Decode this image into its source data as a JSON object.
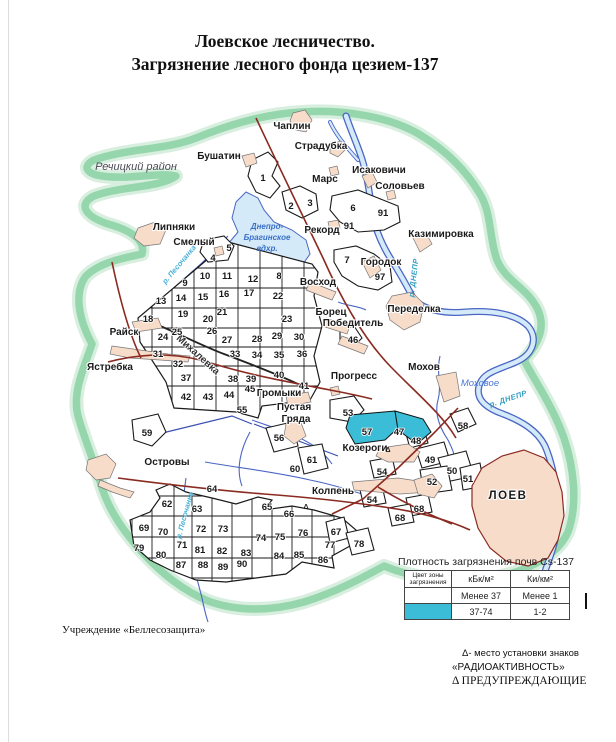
{
  "title": {
    "line1": "Лоевское лесничество.",
    "line2": "Загрязнение лесного фонда цезием-137"
  },
  "colors": {
    "band_green": "#8fd3a6",
    "water_fill": "#d5eaf9",
    "water_line": "#4a66c4",
    "settlement_pink": "#f8dcca",
    "contaminated_cyan": "#3bbdd8",
    "road_dark_red": "#8b2a21"
  },
  "map": {
    "labels": [
      {
        "id": "label-rechitsky-rayon",
        "t": "Речицкий район",
        "x": 136,
        "y": 170,
        "cls": "region"
      },
      {
        "id": "label-chaplin",
        "t": "Чаплин",
        "x": 292,
        "y": 129,
        "cls": "place"
      },
      {
        "id": "label-stradubka",
        "t": "Страдубка",
        "x": 321,
        "y": 149,
        "cls": "place"
      },
      {
        "id": "label-bushatin",
        "t": "Бушатин",
        "x": 219,
        "y": 159,
        "cls": "place"
      },
      {
        "id": "label-mars",
        "t": "Марс",
        "x": 325,
        "y": 182,
        "cls": "place"
      },
      {
        "id": "label-isakovichi",
        "t": "Исаковичи",
        "x": 379,
        "y": 173,
        "cls": "place"
      },
      {
        "id": "label-solovyev",
        "t": "Соловьев",
        "x": 400,
        "y": 189,
        "cls": "place"
      },
      {
        "id": "label-kazimirovka",
        "t": "Казимировка",
        "x": 441,
        "y": 237,
        "cls": "place"
      },
      {
        "id": "label-lipnyaki",
        "t": "Липняки",
        "x": 174,
        "y": 230,
        "cls": "place"
      },
      {
        "id": "label-smely",
        "t": "Смелый",
        "x": 194,
        "y": 245,
        "cls": "place"
      },
      {
        "id": "label-rekord",
        "t": "Рекорд",
        "x": 322,
        "y": 233,
        "cls": "place"
      },
      {
        "id": "label-gorodok",
        "t": "Городок",
        "x": 381,
        "y": 265,
        "cls": "place"
      },
      {
        "id": "label-voskhod",
        "t": "Восход",
        "x": 318,
        "y": 285,
        "cls": "place"
      },
      {
        "id": "label-peredelka",
        "t": "Переделка",
        "x": 414,
        "y": 312,
        "cls": "place"
      },
      {
        "id": "label-borets",
        "t": "Борец",
        "x": 331,
        "y": 315,
        "cls": "place"
      },
      {
        "id": "label-pobeditel",
        "t": "Победитель",
        "x": 353,
        "y": 326,
        "cls": "place"
      },
      {
        "id": "label-raysk",
        "t": "Райск",
        "x": 124,
        "y": 335,
        "cls": "place"
      },
      {
        "id": "label-yastrebka",
        "t": "Ястребка",
        "x": 110,
        "y": 370,
        "cls": "place"
      },
      {
        "id": "label-mikhalevka",
        "t": "Михалевка",
        "x": 196,
        "y": 357,
        "cls": "place-rot",
        "rot": 42
      },
      {
        "id": "label-mokhov",
        "t": "Мохов",
        "x": 424,
        "y": 370,
        "cls": "place"
      },
      {
        "id": "label-progress",
        "t": "Прогресс",
        "x": 354,
        "y": 379,
        "cls": "place"
      },
      {
        "id": "label-gromyki",
        "t": "Громыки",
        "x": 279,
        "y": 396,
        "cls": "place"
      },
      {
        "id": "label-pustaya",
        "t": "Пустая",
        "x": 294,
        "y": 410,
        "cls": "place"
      },
      {
        "id": "label-gryada",
        "t": "Гряда",
        "x": 296,
        "y": 422,
        "cls": "place"
      },
      {
        "id": "label-ostrovy",
        "t": "Островы",
        "x": 167,
        "y": 465,
        "cls": "place"
      },
      {
        "id": "label-kozerogi",
        "t": "Козероги",
        "x": 365,
        "y": 451,
        "cls": "place"
      },
      {
        "id": "label-kolpen",
        "t": "Колпень",
        "x": 333,
        "y": 494,
        "cls": "place"
      },
      {
        "id": "label-loev",
        "t": "ЛОЕВ",
        "x": 508,
        "y": 499,
        "cls": "place-lg"
      },
      {
        "id": "label-reservoir-1",
        "t": "Днепро-",
        "x": 267,
        "y": 229,
        "cls": "water-res"
      },
      {
        "id": "label-reservoir-2",
        "t": "Брагинское",
        "x": 267,
        "y": 240,
        "cls": "water-res"
      },
      {
        "id": "label-reservoir-3",
        "t": "вдхр.",
        "x": 267,
        "y": 251,
        "cls": "water-res"
      },
      {
        "id": "label-pesochanka-upper",
        "t": "р. Песочанка",
        "x": 181,
        "y": 266,
        "cls": "water-sm",
        "rot": -50
      },
      {
        "id": "label-pesochanka-lower",
        "t": "р. Песочанка",
        "x": 187,
        "y": 516,
        "cls": "water-sm",
        "rot": -75
      },
      {
        "id": "label-dnepr-upper",
        "t": "р. ДНЕПР",
        "x": 416,
        "y": 278,
        "cls": "water-riv",
        "rot": -83
      },
      {
        "id": "label-dnepr-lower",
        "t": "р. ДНЕПР",
        "x": 509,
        "y": 401,
        "cls": "water-riv",
        "rot": -18
      },
      {
        "id": "label-mokhovoe",
        "t": "Моховое",
        "x": 480,
        "y": 386,
        "cls": "water-it"
      }
    ],
    "quarters": [
      {
        "id": "q1",
        "n": "1",
        "x": 263,
        "y": 181
      },
      {
        "id": "q2",
        "n": "2",
        "x": 291,
        "y": 209
      },
      {
        "id": "q3",
        "n": "3",
        "x": 310,
        "y": 206
      },
      {
        "id": "q4",
        "n": "4",
        "x": 213,
        "y": 261
      },
      {
        "id": "q5",
        "n": "5",
        "x": 229,
        "y": 251
      },
      {
        "id": "q6",
        "n": "6",
        "x": 353,
        "y": 211
      },
      {
        "id": "q91a",
        "n": "91",
        "x": 383,
        "y": 216
      },
      {
        "id": "q91b",
        "n": "91",
        "x": 349,
        "y": 229
      },
      {
        "id": "q7",
        "n": "7",
        "x": 347,
        "y": 263
      },
      {
        "id": "q97",
        "n": "97",
        "x": 380,
        "y": 280
      },
      {
        "id": "q8",
        "n": "8",
        "x": 279,
        "y": 279
      },
      {
        "id": "q9",
        "n": "9",
        "x": 185,
        "y": 286
      },
      {
        "id": "q10",
        "n": "10",
        "x": 205,
        "y": 279
      },
      {
        "id": "q11",
        "n": "11",
        "x": 227,
        "y": 279
      },
      {
        "id": "q12",
        "n": "12",
        "x": 253,
        "y": 282
      },
      {
        "id": "q13",
        "n": "13",
        "x": 161,
        "y": 304
      },
      {
        "id": "q14",
        "n": "14",
        "x": 181,
        "y": 301
      },
      {
        "id": "q15",
        "n": "15",
        "x": 203,
        "y": 300
      },
      {
        "id": "q16",
        "n": "16",
        "x": 224,
        "y": 297
      },
      {
        "id": "q17",
        "n": "17",
        "x": 249,
        "y": 296
      },
      {
        "id": "q22",
        "n": "22",
        "x": 278,
        "y": 299
      },
      {
        "id": "q18",
        "n": "18",
        "x": 148,
        "y": 322
      },
      {
        "id": "q19",
        "n": "19",
        "x": 183,
        "y": 317
      },
      {
        "id": "q20",
        "n": "20",
        "x": 208,
        "y": 322
      },
      {
        "id": "q21",
        "n": "21",
        "x": 222,
        "y": 315
      },
      {
        "id": "q23",
        "n": "23",
        "x": 287,
        "y": 322
      },
      {
        "id": "q24",
        "n": "24",
        "x": 163,
        "y": 340
      },
      {
        "id": "q25",
        "n": "25",
        "x": 177,
        "y": 335
      },
      {
        "id": "q26",
        "n": "26",
        "x": 212,
        "y": 334
      },
      {
        "id": "q27",
        "n": "27",
        "x": 227,
        "y": 343
      },
      {
        "id": "q28",
        "n": "28",
        "x": 257,
        "y": 342
      },
      {
        "id": "q29",
        "n": "29",
        "x": 277,
        "y": 339
      },
      {
        "id": "q30",
        "n": "30",
        "x": 299,
        "y": 340
      },
      {
        "id": "q31",
        "n": "31",
        "x": 158,
        "y": 357
      },
      {
        "id": "q32",
        "n": "32",
        "x": 178,
        "y": 367
      },
      {
        "id": "q33",
        "n": "33",
        "x": 235,
        "y": 357
      },
      {
        "id": "q34",
        "n": "34",
        "x": 257,
        "y": 358
      },
      {
        "id": "q35",
        "n": "35",
        "x": 279,
        "y": 358
      },
      {
        "id": "q36",
        "n": "36",
        "x": 302,
        "y": 357
      },
      {
        "id": "q37",
        "n": "37",
        "x": 186,
        "y": 381
      },
      {
        "id": "q38",
        "n": "38",
        "x": 233,
        "y": 382
      },
      {
        "id": "q39",
        "n": "39",
        "x": 251,
        "y": 382
      },
      {
        "id": "q40",
        "n": "40",
        "x": 279,
        "y": 378
      },
      {
        "id": "q41",
        "n": "41",
        "x": 304,
        "y": 389
      },
      {
        "id": "q42",
        "n": "42",
        "x": 186,
        "y": 400
      },
      {
        "id": "q43",
        "n": "43",
        "x": 208,
        "y": 400
      },
      {
        "id": "q44",
        "n": "44",
        "x": 229,
        "y": 398
      },
      {
        "id": "q45",
        "n": "45",
        "x": 250,
        "y": 392
      },
      {
        "id": "q46",
        "n": "46",
        "x": 353,
        "y": 343
      },
      {
        "id": "q53",
        "n": "53",
        "x": 348,
        "y": 416
      },
      {
        "id": "q55",
        "n": "55",
        "x": 242,
        "y": 413
      },
      {
        "id": "q56",
        "n": "56",
        "x": 279,
        "y": 441
      },
      {
        "id": "q57",
        "n": "57",
        "x": 367,
        "y": 435
      },
      {
        "id": "q47",
        "n": "47",
        "x": 399,
        "y": 435
      },
      {
        "id": "q48",
        "n": "48",
        "x": 416,
        "y": 444
      },
      {
        "id": "q49",
        "n": "49",
        "x": 430,
        "y": 463
      },
      {
        "id": "q50",
        "n": "50",
        "x": 452,
        "y": 474
      },
      {
        "id": "q51",
        "n": "51",
        "x": 468,
        "y": 482
      },
      {
        "id": "q52",
        "n": "52",
        "x": 432,
        "y": 485
      },
      {
        "id": "q54a",
        "n": "54",
        "x": 382,
        "y": 475
      },
      {
        "id": "q54b",
        "n": "54",
        "x": 372,
        "y": 503
      },
      {
        "id": "q58",
        "n": "58",
        "x": 463,
        "y": 429
      },
      {
        "id": "q59",
        "n": "59",
        "x": 147,
        "y": 436
      },
      {
        "id": "q60",
        "n": "60",
        "x": 295,
        "y": 472
      },
      {
        "id": "q61",
        "n": "61",
        "x": 312,
        "y": 463
      },
      {
        "id": "q62",
        "n": "62",
        "x": 167,
        "y": 507
      },
      {
        "id": "q63",
        "n": "63",
        "x": 197,
        "y": 512
      },
      {
        "id": "q64",
        "n": "64",
        "x": 212,
        "y": 492
      },
      {
        "id": "q65",
        "n": "65",
        "x": 267,
        "y": 510
      },
      {
        "id": "q66",
        "n": "66",
        "x": 289,
        "y": 517
      },
      {
        "id": "q67",
        "n": "67",
        "x": 336,
        "y": 535
      },
      {
        "id": "q68a",
        "n": "68",
        "x": 419,
        "y": 512
      },
      {
        "id": "q68b",
        "n": "68",
        "x": 400,
        "y": 521
      },
      {
        "id": "q69",
        "n": "69",
        "x": 144,
        "y": 531
      },
      {
        "id": "q70",
        "n": "70",
        "x": 163,
        "y": 535
      },
      {
        "id": "q71",
        "n": "71",
        "x": 182,
        "y": 548
      },
      {
        "id": "q72",
        "n": "72",
        "x": 201,
        "y": 532
      },
      {
        "id": "q73",
        "n": "73",
        "x": 223,
        "y": 532
      },
      {
        "id": "q74",
        "n": "74",
        "x": 261,
        "y": 541
      },
      {
        "id": "q75",
        "n": "75",
        "x": 280,
        "y": 540
      },
      {
        "id": "q76",
        "n": "76",
        "x": 303,
        "y": 536
      },
      {
        "id": "q77",
        "n": "77",
        "x": 330,
        "y": 548
      },
      {
        "id": "q78",
        "n": "78",
        "x": 359,
        "y": 547
      },
      {
        "id": "q79",
        "n": "79",
        "x": 139,
        "y": 551
      },
      {
        "id": "q80",
        "n": "80",
        "x": 161,
        "y": 558
      },
      {
        "id": "q81",
        "n": "81",
        "x": 200,
        "y": 553
      },
      {
        "id": "q82",
        "n": "82",
        "x": 222,
        "y": 554
      },
      {
        "id": "q83",
        "n": "83",
        "x": 246,
        "y": 556
      },
      {
        "id": "q84",
        "n": "84",
        "x": 279,
        "y": 559
      },
      {
        "id": "q85",
        "n": "85",
        "x": 299,
        "y": 558
      },
      {
        "id": "q86",
        "n": "86",
        "x": 323,
        "y": 563
      },
      {
        "id": "q87",
        "n": "87",
        "x": 181,
        "y": 568
      },
      {
        "id": "q88",
        "n": "88",
        "x": 203,
        "y": 568
      },
      {
        "id": "q89",
        "n": "89",
        "x": 223,
        "y": 570
      },
      {
        "id": "q90",
        "n": "90",
        "x": 242,
        "y": 567
      }
    ],
    "contaminated_quarters": [
      "57",
      "47"
    ],
    "warning_marks": [
      {
        "x": 388,
        "y": 452
      },
      {
        "x": 306,
        "y": 509
      }
    ]
  },
  "legend": {
    "title": "Плотность загрязнения почв Cs-137",
    "col_zone": "Цвет зоны загрязнения",
    "col_kbk": "кБк/м²",
    "col_ki": "Ки/км²",
    "rows": [
      {
        "color": "#ffffff",
        "kbk": "Менее 37",
        "ki": "Менее 1"
      },
      {
        "color": "#3bbdd8",
        "kbk": "37-74",
        "ki": "1-2"
      }
    ]
  },
  "footer": {
    "left": "Учреждение «Беллесозащита»",
    "right1": "Δ- место установки знаков",
    "right2": "«РАДИОАКТИВНОСТЬ»",
    "right3": "Δ ПРЕДУПРЕЖДАЮЩИЕ"
  }
}
